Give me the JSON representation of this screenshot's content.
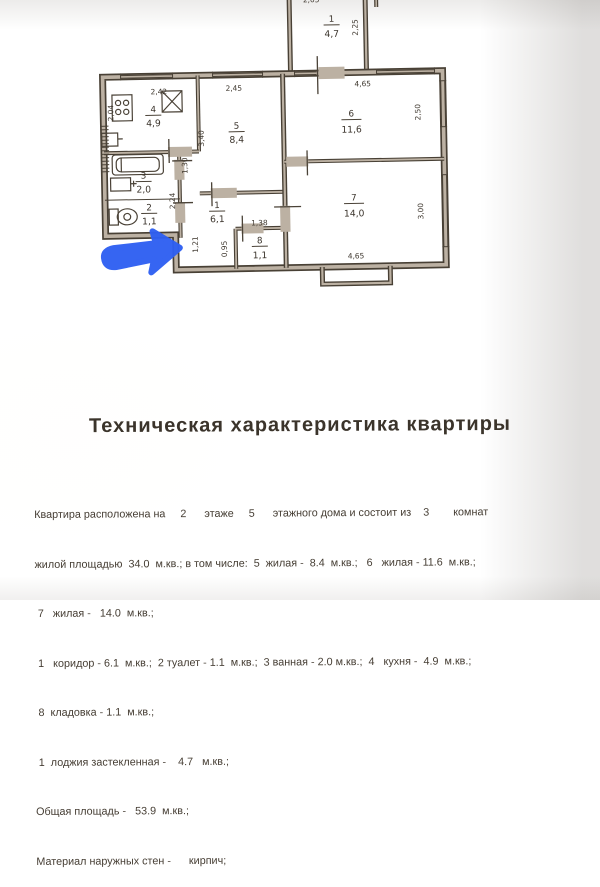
{
  "document": {
    "title": "Техническая характеристика квартиры",
    "body_lines": [
      "Квартира расположена на     2      этаже     5      этажного дома и состоит из    3        комнат",
      "жилой площадью  34.0  м.кв.; в том числе:  5  жилая -  8.4  м.кв.;   6   жилая - 11.6  м.кв.;",
      " 7   жилая -   14.0  м.кв.;",
      " 1   коридор - 6.1  м.кв.;  2 туалет - 1.1  м.кв.;  3 ванная - 2.0 м.кв.;  4   кухня -  4.9  м.кв.;",
      " 8  кладовка - 1.1  м.кв.;",
      " 1  лоджия застекленная -    4.7   м.кв.;",
      "Общая площадь -   53.9  м.кв.;",
      "Материал наружных стен -      кирпич;"
    ]
  },
  "plan": {
    "rooms": [
      {
        "key": "kitchen",
        "number": "4",
        "area": "4,9"
      },
      {
        "key": "room5",
        "number": "5",
        "area": "8,4"
      },
      {
        "key": "room6",
        "number": "6",
        "area": "11,6"
      },
      {
        "key": "room7",
        "number": "7",
        "area": "14,0"
      },
      {
        "key": "corridor",
        "number": "1",
        "area": "6,1"
      },
      {
        "key": "bathroom",
        "number": "3",
        "area": "2,0"
      },
      {
        "key": "toilet",
        "number": "2",
        "area": "1,1"
      },
      {
        "key": "storage",
        "number": "8",
        "area": "1,1"
      },
      {
        "key": "loggia",
        "number": "1",
        "area": "4,7"
      }
    ],
    "dimensions": {
      "top_kitchen": "2,42",
      "top_room5": "2,45",
      "top_room6": "4,65",
      "left_kitchen": "2,04",
      "room5_height": "3,40",
      "room6_height": "2,50",
      "room7_height": "3,00",
      "room7_width": "4,65",
      "loggia_height": "2,25",
      "loggia_width_cut": "2,05",
      "corridor_130": "1,30",
      "corridor_224": "2,24",
      "step_121": "1,21",
      "storage_095": "0,95",
      "storage_138": "1,38"
    },
    "annotation_color": "#2e5ff2"
  }
}
